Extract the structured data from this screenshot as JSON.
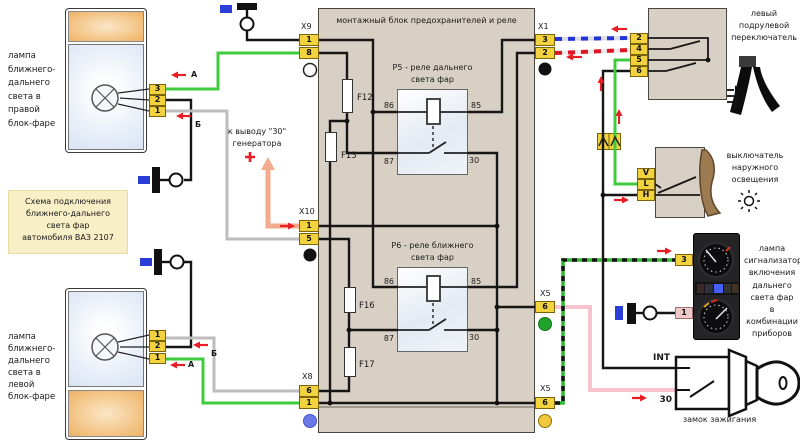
{
  "title": "монтажный блок предохранителей и реле",
  "info_box": "Схема подключения\nближнего-дальнего\nсвета фар\nавтомобиля ВАЗ 2107",
  "lamps": {
    "right": {
      "label": "лампа\nближнего-\nдальнего\nсвета в\nправой\nблок-фаре",
      "pins": [
        "3",
        "2",
        "1"
      ]
    },
    "left": {
      "label": "лампа\nближнего-\nдальнего\nсвета в\nлевой\nблок-фаре",
      "pins": [
        "1",
        "2",
        "1"
      ]
    }
  },
  "connectors": {
    "x9": {
      "name": "X9",
      "pins": [
        "1",
        "8"
      ]
    },
    "x10": {
      "name": "X10",
      "pins": [
        "1",
        "5"
      ]
    },
    "x8": {
      "name": "X8",
      "pins": [
        "6",
        "1"
      ]
    },
    "x1": {
      "name": "X1",
      "pins": [
        "3",
        "2"
      ]
    },
    "x5_upper": {
      "name": "X5",
      "pins": [
        "6"
      ]
    },
    "x5_lower": {
      "name": "X5",
      "pins": [
        "6"
      ]
    }
  },
  "relays": {
    "p5": {
      "label": "Р5 - реле дальнего\nсвета фар",
      "terminals": [
        "86",
        "85",
        "87",
        "30"
      ]
    },
    "p6": {
      "label": "Р6 - реле ближнего\nсвета фар",
      "terminals": [
        "86",
        "85",
        "87",
        "30"
      ]
    }
  },
  "fuses": [
    "F12",
    "F13",
    "F16",
    "F17"
  ],
  "generator_note": "к выводу \"30\"\nгенератора",
  "plus_sign": "+",
  "tags": {
    "a_top": "А",
    "b_top": "Б",
    "b_bottom": "Б",
    "a_bottom": "А"
  },
  "steering_switch": {
    "label": "левый\nподрулевой\nпереключатель",
    "pins": [
      "2",
      "4",
      "5",
      "6"
    ]
  },
  "light_switch": {
    "label": "выключатель\nнаружного\nосвещения",
    "pins": [
      "V",
      "L",
      "H"
    ]
  },
  "cluster": {
    "label": "лампа\nсигнализатор\nвключения\nдальнего\nсвета фар\nв комбинации\nприборов",
    "pins": [
      "3",
      "1"
    ]
  },
  "ignition": {
    "label": "замок зажигания",
    "int_label": "INT",
    "t30_label": "30"
  },
  "colors": {
    "block_bg": "#d9d0c5",
    "pin_yellow": "#f2d23e",
    "wire_green": "#3ecb3e",
    "wire_gray": "#bdbdbd",
    "wire_pink": "#f7c3cf",
    "wire_salmon": "#f2ab8e",
    "arrow_red": "#e81c24",
    "marker_blue": "#2b3fd8"
  }
}
